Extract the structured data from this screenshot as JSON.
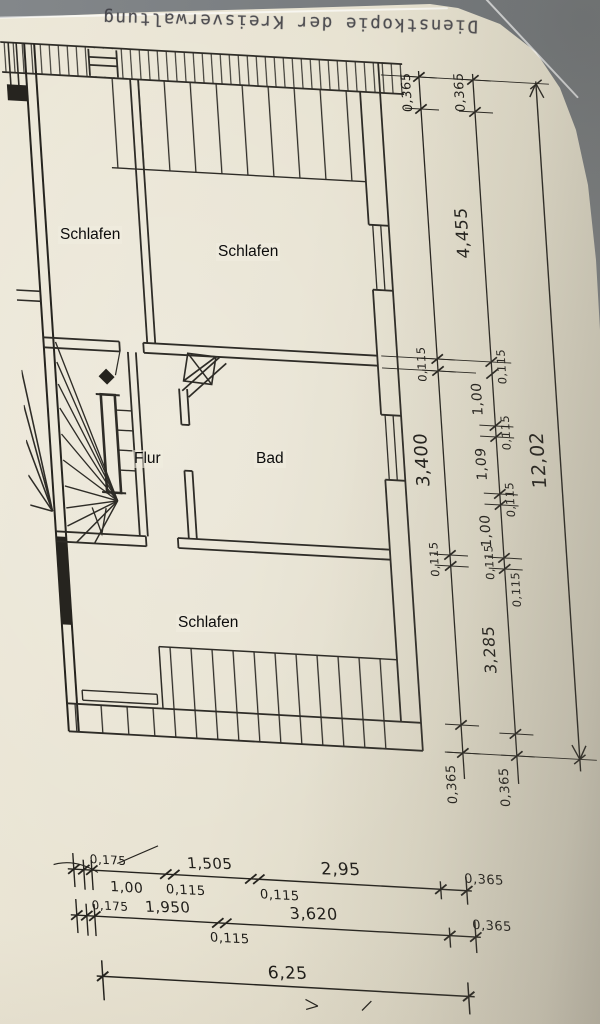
{
  "stamp": {
    "text": "Dienstkopie der Kreisverwaltung"
  },
  "rooms": [
    {
      "label": "Schlafen"
    },
    {
      "label": "Schlafen"
    },
    {
      "label": "Flur"
    },
    {
      "label": "Bad"
    },
    {
      "label": "Schlafen"
    }
  ],
  "dims": {
    "chain_inner": [
      "0,365",
      "0,115",
      "3,400",
      "0,115",
      "0,365"
    ],
    "chain_mid": [
      "0,365",
      "4,455",
      "0,115",
      "1,00",
      "0,115",
      "1,09",
      "0,115",
      "1,00",
      "0,115",
      "0,115",
      "3,285",
      "0,365"
    ],
    "total_height": "12,02",
    "line1_above": [
      "0,175",
      "1,505",
      "2,95",
      "0,365"
    ],
    "line1_below": [
      "1,00",
      "0,115",
      "0,115"
    ],
    "line2_above": [
      "0,175",
      "1,950",
      "3,620",
      "0,365"
    ],
    "line2_below": [
      "0,115"
    ],
    "total_width": "6,25"
  },
  "colors": {
    "paper": "#e8e3d2",
    "ink": "#2e2c27",
    "backdrop": "#82868a"
  }
}
